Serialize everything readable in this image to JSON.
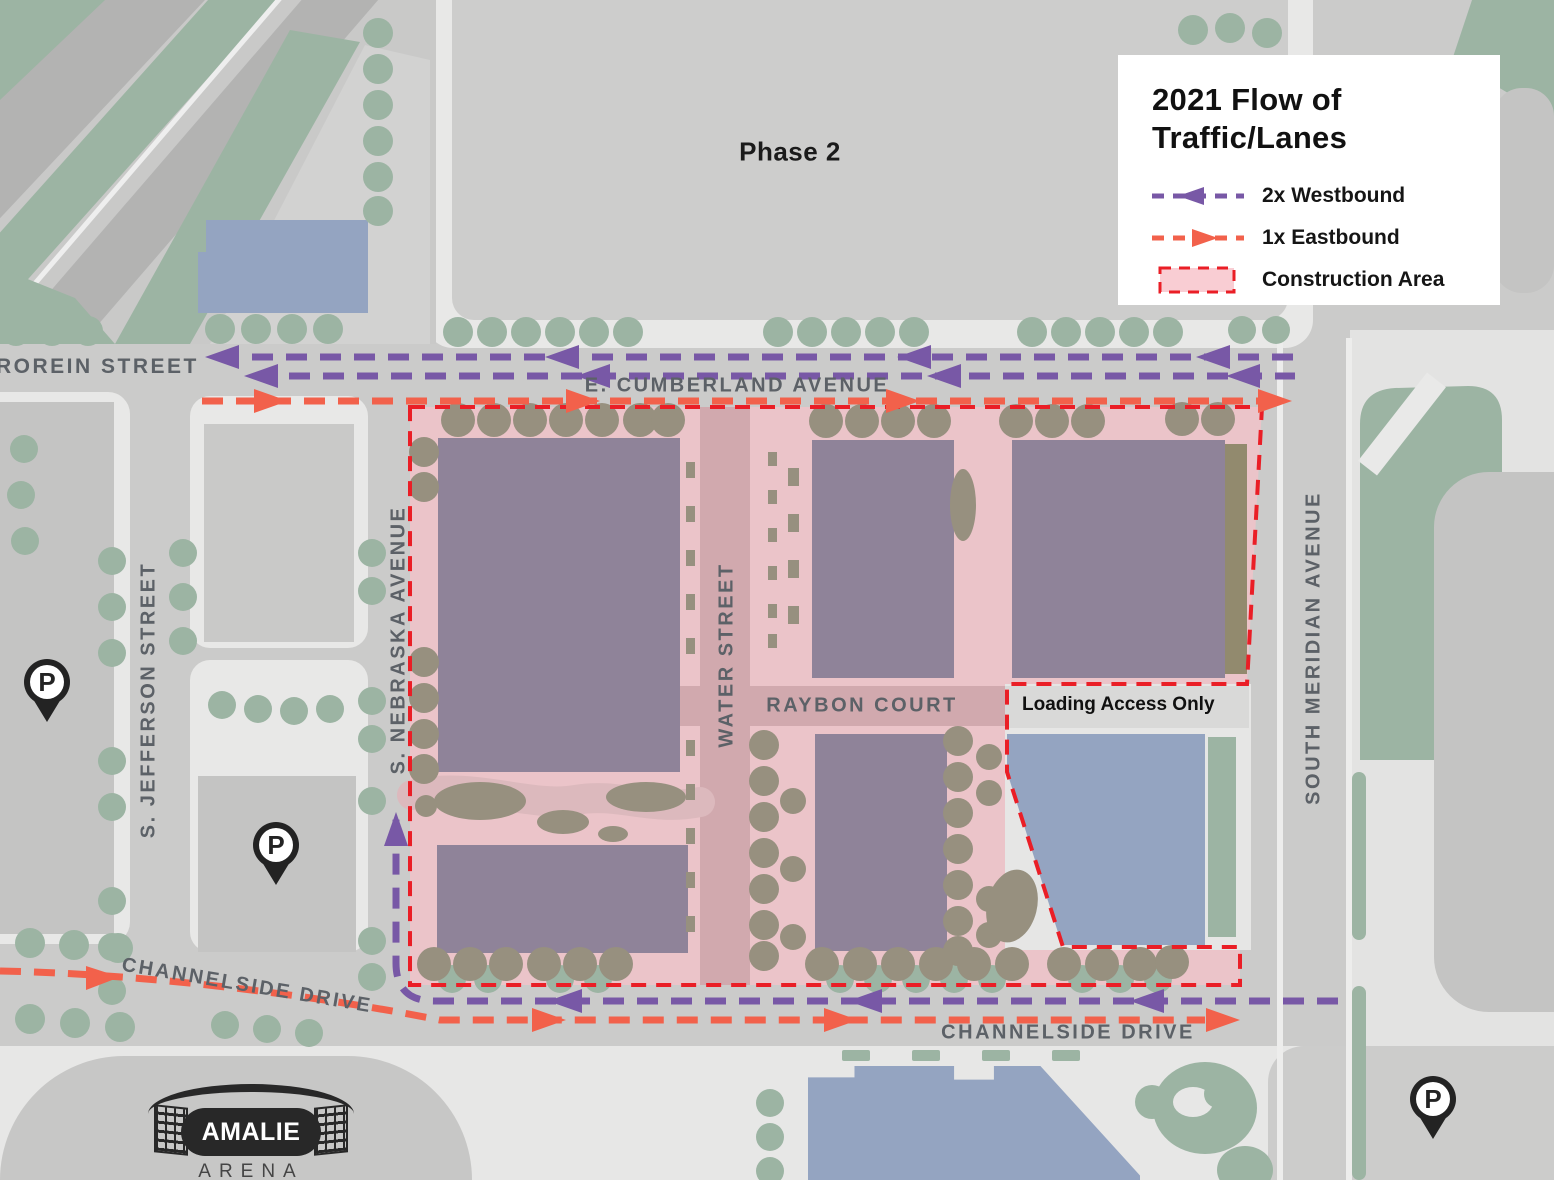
{
  "legend": {
    "title": [
      "2021 Flow of",
      "Traffic/Lanes"
    ],
    "items": [
      {
        "label": "2x Westbound",
        "color": "#7858a6",
        "type": "dashed-arrow-left"
      },
      {
        "label": "1x Eastbound",
        "color": "#f2614b",
        "type": "dashed-arrow-right"
      },
      {
        "label": "Construction Area",
        "border": "#ea1e26",
        "fill": "#f9cdd3",
        "type": "dashed-rect"
      }
    ]
  },
  "map_labels": {
    "phase": "Phase 2",
    "brorein": "ROREIN STREET",
    "cumberland": "E. CUMBERLAND AVENUE",
    "jefferson": "S. JEFFERSON STREET",
    "nebraska": "S. NEBRASKA AVENUE",
    "water": "WATER STREET",
    "raybon": "RAYBON COURT",
    "meridian": "SOUTH MERIDIAN AVENUE",
    "channelside_west": "CHANNELSIDE DRIVE",
    "channelside_east": "CHANNELSIDE DRIVE",
    "loading": "Loading Access Only"
  },
  "arena": {
    "name": "AMALIE",
    "type": "ARENA"
  },
  "parking_symbol": "P",
  "colors": {
    "westbound": "#7858a6",
    "eastbound": "#f2614b",
    "construction_border": "#ea1e26",
    "construction_fill": "#ebc4c9",
    "construction_road": "#d1a9ae",
    "building_construction": "#8f8399",
    "building_blue": "#94a4c1",
    "tree_green": "#9cb4a3",
    "tree_construction": "#97907f",
    "road": "#cbcbca",
    "street_label": "#5c6167"
  }
}
